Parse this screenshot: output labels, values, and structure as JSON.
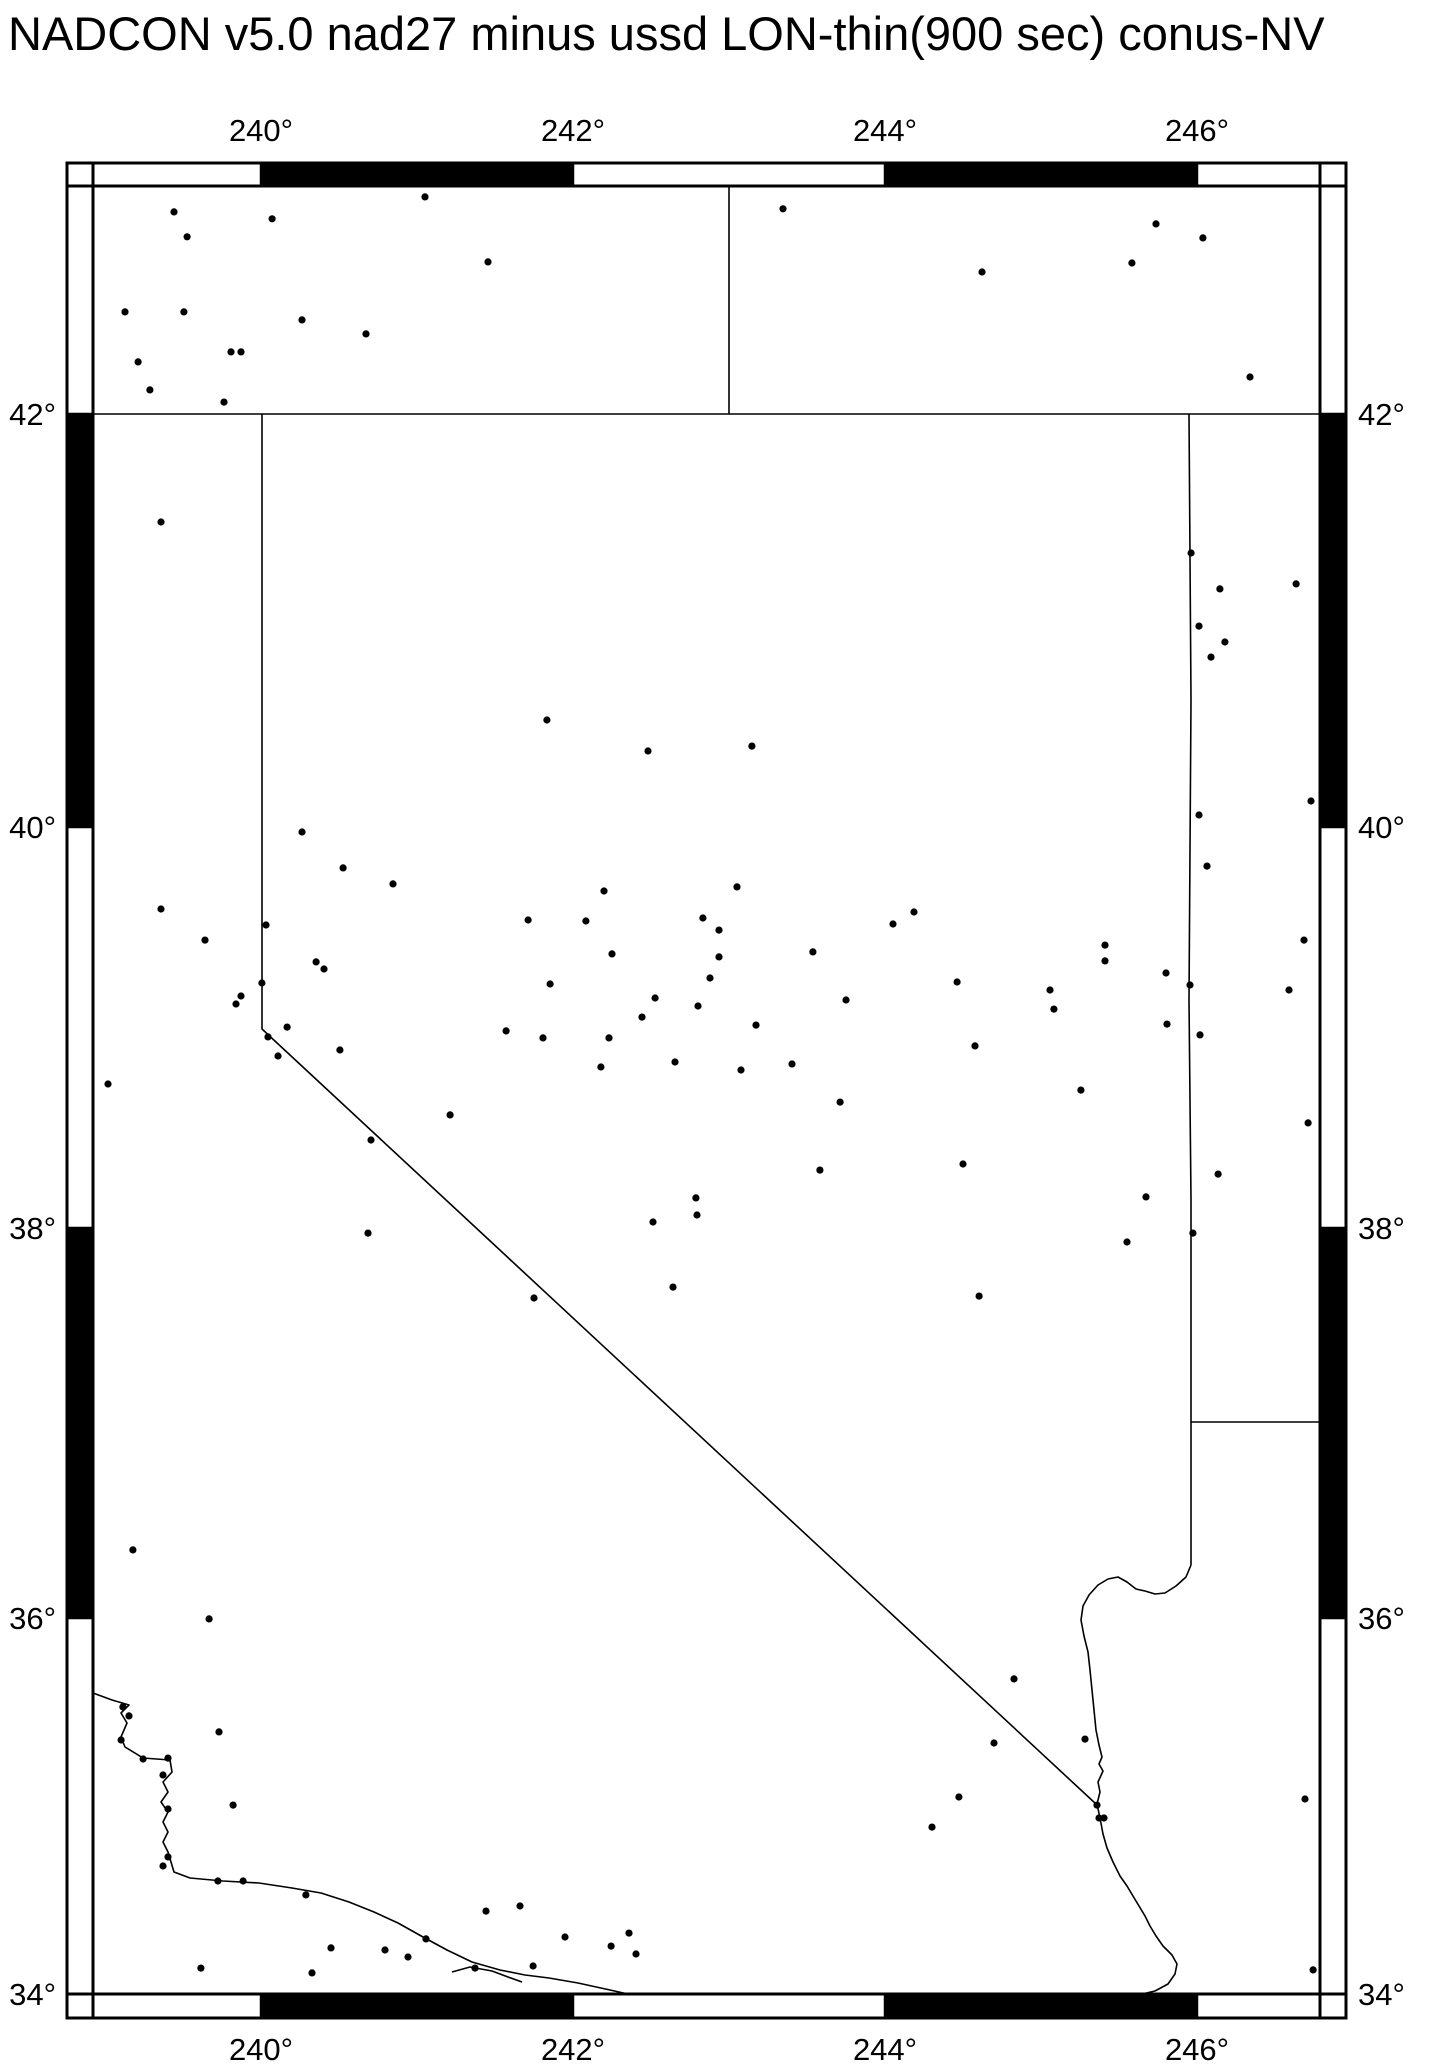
{
  "title": "NADCON v5.0 nad27 minus ussd LON-thin(900 sec) conus-NV",
  "colors": {
    "ink": "#000000",
    "paper": "#ffffff"
  },
  "chart_data": {
    "type": "scatter",
    "title": "NADCON v5.0 nad27 minus ussd LON-thin(900 sec) conus-NV",
    "projection": "mercator",
    "region_note": "conus-NV (Nevada and surrounding states, state borders and coast shown)",
    "xlabel": "longitude (degrees east)",
    "ylabel": "latitude (degrees north)",
    "lon_range": [
      238.92,
      246.79
    ],
    "lat_range": [
      34.0,
      43.09
    ],
    "grid": false,
    "legend": "none",
    "marker": "filled black circle",
    "x_ticks": [
      {
        "value": 240,
        "label": "240°"
      },
      {
        "value": 242,
        "label": "242°"
      },
      {
        "value": 244,
        "label": "244°"
      },
      {
        "value": 246,
        "label": "246°"
      }
    ],
    "y_ticks": [
      {
        "value": 42,
        "label": "42°"
      },
      {
        "value": 40,
        "label": "40°"
      },
      {
        "value": 38,
        "label": "38°"
      },
      {
        "value": 36,
        "label": "36°"
      },
      {
        "value": 34,
        "label": "34°"
      }
    ],
    "points_lonlat": [
      [
        239.442,
        42.966
      ],
      [
        240.071,
        42.933
      ],
      [
        239.526,
        42.847
      ],
      [
        241.051,
        43.038
      ],
      [
        241.455,
        42.727
      ],
      [
        239.128,
        42.488
      ],
      [
        239.506,
        42.488
      ],
      [
        240.263,
        42.45
      ],
      [
        240.673,
        42.383
      ],
      [
        239.808,
        42.297
      ],
      [
        239.872,
        42.297
      ],
      [
        239.212,
        42.249
      ],
      [
        239.288,
        42.115
      ],
      [
        239.763,
        42.057
      ],
      [
        243.346,
        42.981
      ],
      [
        245.737,
        42.909
      ],
      [
        246.038,
        42.842
      ],
      [
        245.583,
        42.722
      ],
      [
        244.622,
        42.679
      ],
      [
        246.34,
        42.177
      ],
      [
        239.359,
        41.477
      ],
      [
        241.833,
        40.518
      ],
      [
        242.481,
        40.368
      ],
      [
        243.147,
        40.392
      ],
      [
        240.263,
        39.975
      ],
      [
        240.526,
        39.796
      ],
      [
        240.846,
        39.716
      ],
      [
        239.359,
        39.591
      ],
      [
        239.641,
        39.436
      ],
      [
        240.032,
        39.511
      ],
      [
        240.353,
        39.327
      ],
      [
        240.404,
        39.292
      ],
      [
        240.006,
        39.222
      ],
      [
        239.872,
        39.157
      ],
      [
        239.84,
        39.117
      ],
      [
        240.167,
        39.002
      ],
      [
        240.045,
        38.953
      ],
      [
        240.109,
        38.858
      ],
      [
        240.506,
        38.888
      ],
      [
        239.019,
        38.718
      ],
      [
        242.199,
        39.681
      ],
      [
        243.051,
        39.701
      ],
      [
        241.712,
        39.536
      ],
      [
        242.083,
        39.531
      ],
      [
        242.833,
        39.546
      ],
      [
        242.936,
        39.486
      ],
      [
        242.25,
        39.367
      ],
      [
        242.936,
        39.352
      ],
      [
        243.538,
        39.377
      ],
      [
        242.878,
        39.247
      ],
      [
        241.853,
        39.217
      ],
      [
        242.526,
        39.147
      ],
      [
        242.801,
        39.107
      ],
      [
        242.442,
        39.052
      ],
      [
        243.75,
        39.137
      ],
      [
        243.173,
        39.012
      ],
      [
        241.571,
        38.983
      ],
      [
        241.808,
        38.948
      ],
      [
        242.231,
        38.948
      ],
      [
        245.962,
        41.327
      ],
      [
        246.147,
        41.153
      ],
      [
        246.635,
        41.177
      ],
      [
        246.013,
        40.973
      ],
      [
        246.179,
        40.896
      ],
      [
        246.09,
        40.823
      ],
      [
        246.731,
        40.126
      ],
      [
        246.013,
        40.058
      ],
      [
        246.064,
        39.805
      ],
      [
        244.186,
        39.576
      ],
      [
        244.051,
        39.516
      ],
      [
        245.41,
        39.411
      ],
      [
        245.41,
        39.332
      ],
      [
        244.462,
        39.227
      ],
      [
        245.801,
        39.272
      ],
      [
        245.955,
        39.212
      ],
      [
        245.058,
        39.187
      ],
      [
        245.083,
        39.092
      ],
      [
        246.686,
        39.436
      ],
      [
        246.59,
        39.187
      ],
      [
        245.808,
        39.017
      ],
      [
        246.019,
        38.963
      ],
      [
        242.179,
        38.803
      ],
      [
        242.654,
        38.828
      ],
      [
        243.077,
        38.788
      ],
      [
        243.404,
        38.818
      ],
      [
        243.712,
        38.628
      ],
      [
        241.212,
        38.564
      ],
      [
        240.705,
        38.439
      ],
      [
        243.583,
        38.289
      ],
      [
        242.788,
        38.15
      ],
      [
        242.795,
        38.065
      ],
      [
        242.513,
        38.03
      ],
      [
        240.686,
        37.974
      ],
      [
        242.641,
        37.697
      ],
      [
        241.75,
        37.641
      ],
      [
        244.577,
        38.908
      ],
      [
        245.256,
        38.688
      ],
      [
        246.712,
        38.524
      ],
      [
        244.5,
        38.319
      ],
      [
        246.135,
        38.269
      ],
      [
        245.673,
        38.155
      ],
      [
        245.974,
        37.974
      ],
      [
        245.551,
        37.928
      ],
      [
        244.603,
        37.651
      ],
      [
        239.179,
        36.349
      ],
      [
        239.667,
        35.995
      ],
      [
        239.115,
        35.527
      ],
      [
        239.154,
        35.479
      ],
      [
        239.103,
        35.351
      ],
      [
        239.731,
        35.394
      ],
      [
        239.244,
        35.25
      ],
      [
        239.404,
        35.255
      ],
      [
        239.372,
        35.165
      ],
      [
        239.821,
        35.005
      ],
      [
        239.404,
        34.984
      ],
      [
        239.404,
        34.729
      ],
      [
        239.372,
        34.681
      ],
      [
        239.724,
        34.601
      ],
      [
        239.885,
        34.601
      ],
      [
        240.288,
        34.527
      ],
      [
        240.449,
        34.245
      ],
      [
        240.327,
        34.112
      ],
      [
        239.615,
        34.138
      ],
      [
        241.058,
        34.293
      ],
      [
        240.795,
        34.234
      ],
      [
        240.942,
        34.197
      ],
      [
        241.442,
        34.441
      ],
      [
        241.66,
        34.468
      ],
      [
        241.372,
        34.138
      ],
      [
        241.744,
        34.149
      ],
      [
        241.949,
        34.303
      ],
      [
        242.359,
        34.324
      ],
      [
        242.244,
        34.255
      ],
      [
        242.404,
        34.213
      ],
      [
        244.827,
        35.676
      ],
      [
        245.282,
        35.356
      ],
      [
        244.699,
        35.335
      ],
      [
        244.474,
        35.048
      ],
      [
        245.359,
        35.005
      ],
      [
        245.372,
        34.936
      ],
      [
        245.404,
        34.936
      ],
      [
        244.301,
        34.888
      ],
      [
        246.692,
        35.037
      ],
      [
        246.744,
        34.128
      ]
    ]
  },
  "map_layers_px": [
    {
      "name": "latitude-42-border",
      "points": [
        [
          93,
          414
        ],
        [
          1320,
          414
        ]
      ]
    },
    {
      "name": "oregon-idaho-border",
      "points": [
        [
          729,
          186
        ],
        [
          729,
          414
        ]
      ]
    },
    {
      "name": "nevada-california-border",
      "points": [
        [
          262,
          414
        ],
        [
          262,
          1029
        ],
        [
          1096,
          1804
        ]
      ]
    },
    {
      "name": "nevada-utah-border",
      "points": [
        [
          1189,
          414
        ],
        [
          1191,
          700
        ],
        [
          1189,
          1000
        ],
        [
          1191,
          1200
        ],
        [
          1191,
          1427
        ]
      ]
    },
    {
      "name": "utah-arizona-border",
      "points": [
        [
          1191,
          1422
        ],
        [
          1320,
          1422
        ]
      ]
    },
    {
      "name": "nevada-arizona-border",
      "points": [
        [
          1191,
          1427
        ],
        [
          1191,
          1565
        ]
      ]
    },
    {
      "name": "colorado-river",
      "points": [
        [
          1191,
          1565
        ],
        [
          1186,
          1577
        ],
        [
          1176,
          1586
        ],
        [
          1165,
          1593
        ],
        [
          1155,
          1594
        ],
        [
          1145,
          1591
        ],
        [
          1136,
          1589
        ],
        [
          1127,
          1582
        ],
        [
          1118,
          1577
        ],
        [
          1108,
          1579
        ],
        [
          1098,
          1585
        ],
        [
          1089,
          1595
        ],
        [
          1083,
          1606
        ],
        [
          1081,
          1620
        ],
        [
          1084,
          1636
        ],
        [
          1088,
          1652
        ],
        [
          1090,
          1670
        ],
        [
          1092,
          1690
        ],
        [
          1094,
          1710
        ],
        [
          1096,
          1730
        ],
        [
          1099,
          1745
        ],
        [
          1102,
          1757
        ],
        [
          1099,
          1764
        ],
        [
          1103,
          1771
        ],
        [
          1098,
          1782
        ],
        [
          1100,
          1792
        ],
        [
          1097,
          1804
        ],
        [
          1100,
          1818
        ],
        [
          1103,
          1834
        ],
        [
          1107,
          1848
        ],
        [
          1113,
          1862
        ],
        [
          1120,
          1876
        ],
        [
          1127,
          1886
        ],
        [
          1133,
          1896
        ],
        [
          1139,
          1906
        ],
        [
          1145,
          1916
        ],
        [
          1150,
          1926
        ],
        [
          1156,
          1936
        ],
        [
          1163,
          1946
        ],
        [
          1172,
          1955
        ],
        [
          1177,
          1964
        ],
        [
          1175,
          1974
        ],
        [
          1168,
          1984
        ],
        [
          1155,
          1991
        ],
        [
          1142,
          1994
        ]
      ]
    },
    {
      "name": "pacific-coastline",
      "points": [
        [
          93,
          1693
        ],
        [
          112,
          1700
        ],
        [
          129,
          1705
        ],
        [
          121,
          1713
        ],
        [
          127,
          1723
        ],
        [
          121,
          1737
        ],
        [
          125,
          1747
        ],
        [
          143,
          1758
        ],
        [
          170,
          1760
        ],
        [
          172,
          1772
        ],
        [
          163,
          1782
        ],
        [
          168,
          1792
        ],
        [
          161,
          1802
        ],
        [
          168,
          1812
        ],
        [
          163,
          1822
        ],
        [
          168,
          1832
        ],
        [
          163,
          1842
        ],
        [
          168,
          1852
        ],
        [
          174,
          1872
        ],
        [
          190,
          1878
        ],
        [
          223,
          1881
        ],
        [
          259,
          1883
        ],
        [
          292,
          1888
        ],
        [
          321,
          1893
        ],
        [
          349,
          1902
        ],
        [
          374,
          1912
        ],
        [
          398,
          1923
        ],
        [
          423,
          1937
        ],
        [
          447,
          1950
        ],
        [
          472,
          1962
        ],
        [
          500,
          1970
        ],
        [
          525,
          1975
        ],
        [
          549,
          1978
        ],
        [
          578,
          1983
        ],
        [
          610,
          1990
        ],
        [
          628,
          1994
        ]
      ]
    },
    {
      "name": "channel-island-coastline",
      "points": [
        [
          452,
          1972
        ],
        [
          470,
          1967
        ],
        [
          492,
          1971
        ],
        [
          508,
          1977
        ],
        [
          522,
          1982
        ]
      ]
    }
  ],
  "frame": {
    "outer": [
      67,
      163,
      1346,
      2018
    ],
    "inner": [
      93,
      186,
      1320,
      1994
    ],
    "x_segments": [
      [
        93,
        261,
        "white"
      ],
      [
        261,
        573,
        "black"
      ],
      [
        573,
        885,
        "white"
      ],
      [
        885,
        1197,
        "black"
      ],
      [
        1197,
        1320,
        "white"
      ]
    ],
    "y_segments": [
      [
        186,
        414,
        "white"
      ],
      [
        414,
        827,
        "black"
      ],
      [
        827,
        1228,
        "white"
      ],
      [
        1228,
        1618,
        "black"
      ],
      [
        1618,
        1994,
        "white"
      ]
    ]
  }
}
